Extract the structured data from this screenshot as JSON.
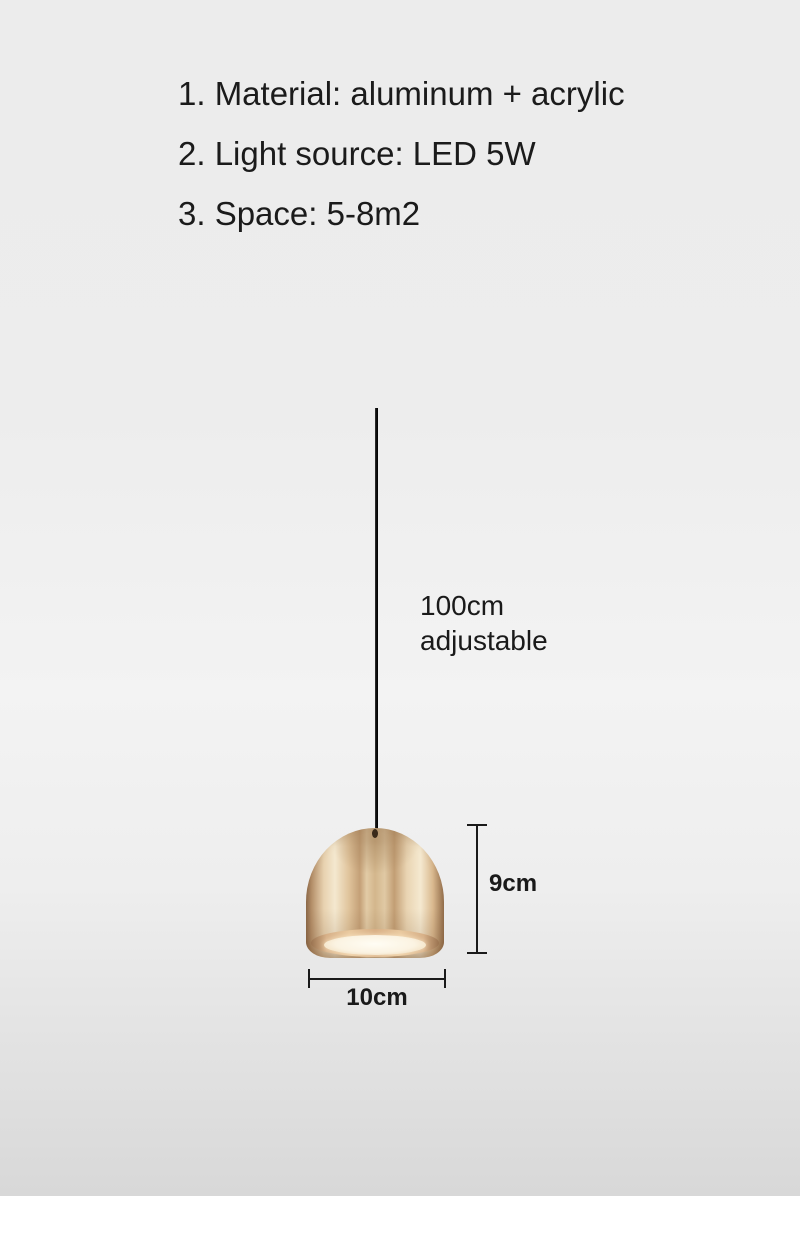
{
  "page": {
    "background_top_color": "#ececec",
    "background_bottom_color": "#d8d8d8",
    "footer_strip_color": "#ffffff"
  },
  "specs": {
    "items": [
      "1. Material: aluminum + acrylic",
      "2. Light source: LED 5W",
      "3. Space: 5-8m2"
    ]
  },
  "annotations": {
    "cord_length_line1": "100cm",
    "cord_length_line2": "adjustable",
    "height_label": "9cm",
    "width_label": "10cm"
  },
  "product": {
    "type": "pendant-lamp",
    "shade_base_color": "#d3b68c",
    "shade_highlight_color": "#f5e9d0",
    "shade_edge_color": "#8f6c4c",
    "diffuser_color": "#fdf8ec",
    "cord_color": "#111111",
    "dimension_line_color": "#1a1a1a"
  }
}
